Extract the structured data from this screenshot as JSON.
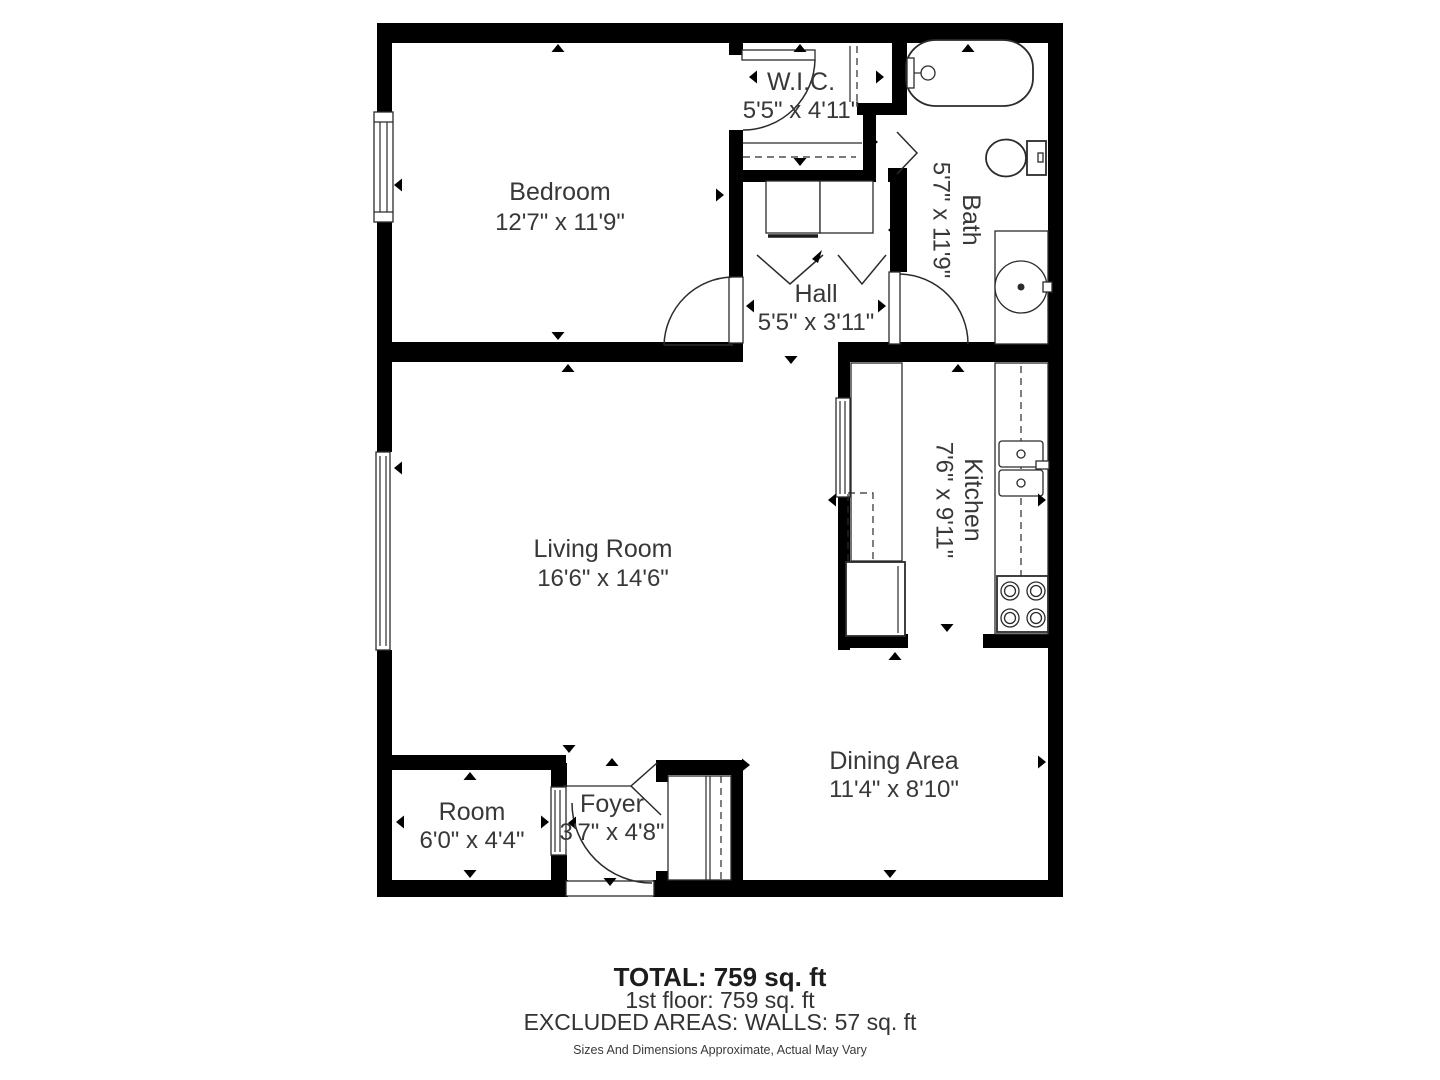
{
  "plan": {
    "rooms": [
      {
        "name": "Bedroom",
        "dims": "12'7\" x 11'9\""
      },
      {
        "name": "W.I.C.",
        "dims": "5'5\" x 4'11\""
      },
      {
        "name": "Bath",
        "dims": "5'7\" x 11'9\""
      },
      {
        "name": "Hall",
        "dims": "5'5\" x 3'11\""
      },
      {
        "name": "Living Room",
        "dims": "16'6\" x 14'6\""
      },
      {
        "name": "Kitchen",
        "dims": "7'6\" x 9'11\""
      },
      {
        "name": "Dining Area",
        "dims": "11'4\" x 8'10\""
      },
      {
        "name": "Room",
        "dims": "6'0\" x 4'4\""
      },
      {
        "name": "Foyer",
        "dims": "3'7\" x 4'8\""
      }
    ],
    "summary": {
      "total": "TOTAL: 759 sq. ft",
      "first_floor": "1st floor: 759 sq. ft",
      "excluded": "EXCLUDED AREAS: WALLS: 57 sq. ft",
      "disclaimer": "Sizes And Dimensions Approximate, Actual May Vary"
    },
    "colors": {
      "wall": "#000000",
      "label": "#383838",
      "background": "#ffffff"
    }
  }
}
